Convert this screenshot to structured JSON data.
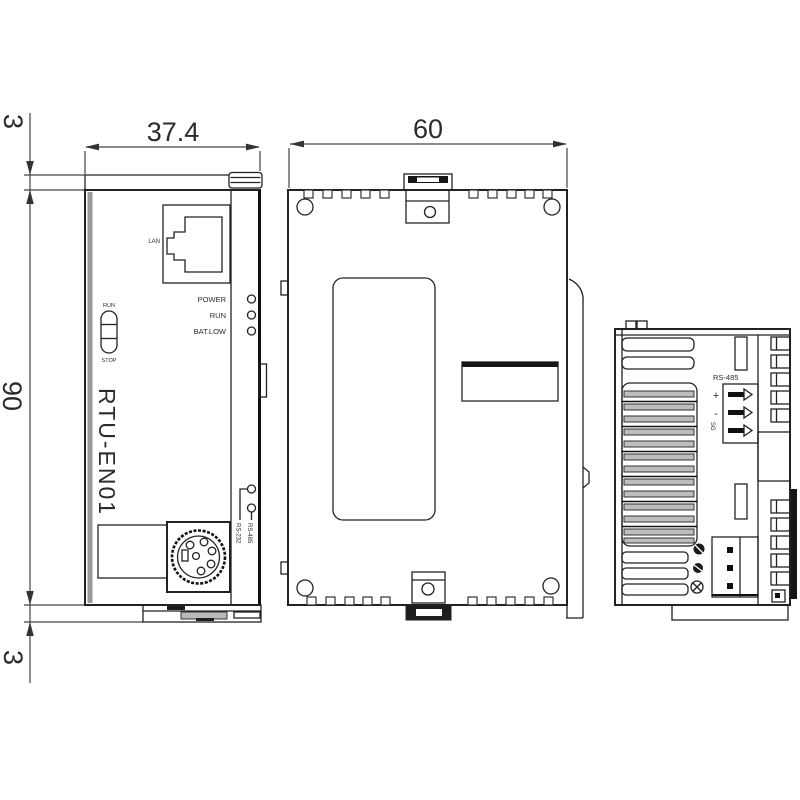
{
  "page": {
    "background": "#ffffff",
    "line_color": "#222222",
    "accent_gray": "#b9b9b9"
  },
  "dims": {
    "top_tab": "3",
    "front_width": "37.4",
    "depth": "60",
    "height": "90",
    "bottom_tab": "3"
  },
  "front": {
    "model": "RTU-EN01",
    "lan": "LAN",
    "switch_top": "RUN",
    "switch_bottom": "STOP",
    "led_power": "POWER",
    "led_run": "RUN",
    "led_batlow": "BAT.LOW",
    "sel_top": "RS-232",
    "sel_bottom": "RS-485"
  },
  "rear": {
    "port_label": "RS-485",
    "t_plus": "+",
    "t_minus": "-",
    "t_sg": "SG"
  }
}
